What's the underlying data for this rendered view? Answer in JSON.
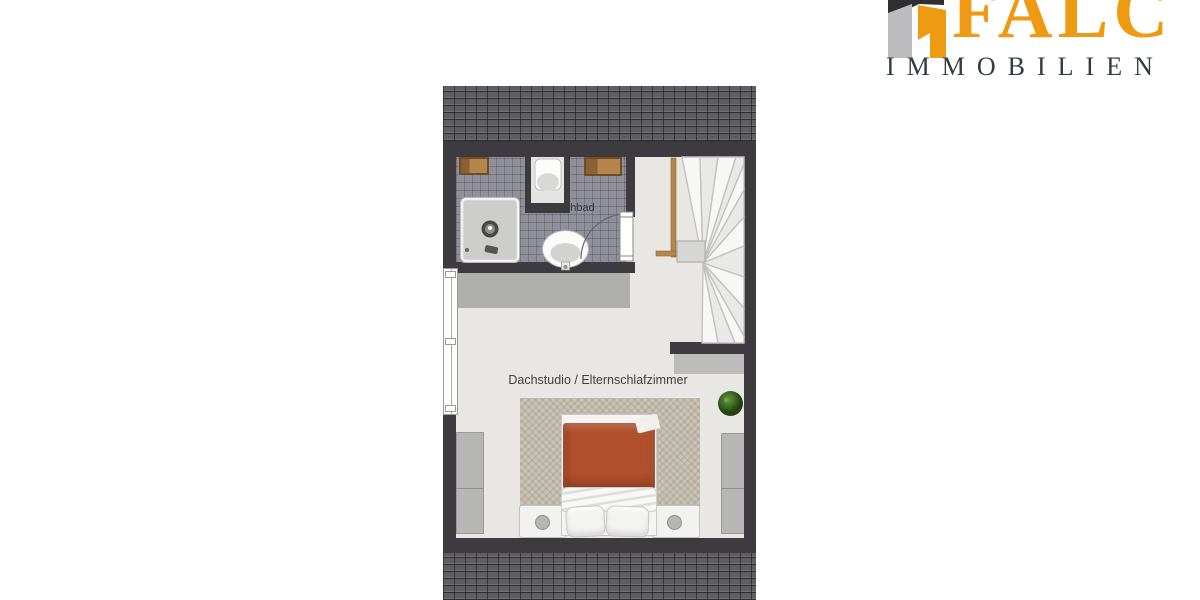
{
  "logo": {
    "brand": "FALC",
    "subtitle": "IMMOBILIEN",
    "brand_color": "#EE9B13",
    "subtitle_color": "#343B44",
    "icon": "falc-house-logo"
  },
  "floorplan": {
    "bathroom_label": "Duschbad",
    "main_room_label": "Dachstudio / Elternschlafzimmer",
    "colors": {
      "wall": "#3D3B3F",
      "roof_tiles": "#5E5E62",
      "bathroom_tiles": "#90909A",
      "floor": "#E9E7E4",
      "rug": "#CAC4B7",
      "bed_duvet": "#B0502C",
      "wood_rail": "#B5854E",
      "plant": "#3C6A22",
      "gray_furniture": "#B6B6B4"
    }
  }
}
